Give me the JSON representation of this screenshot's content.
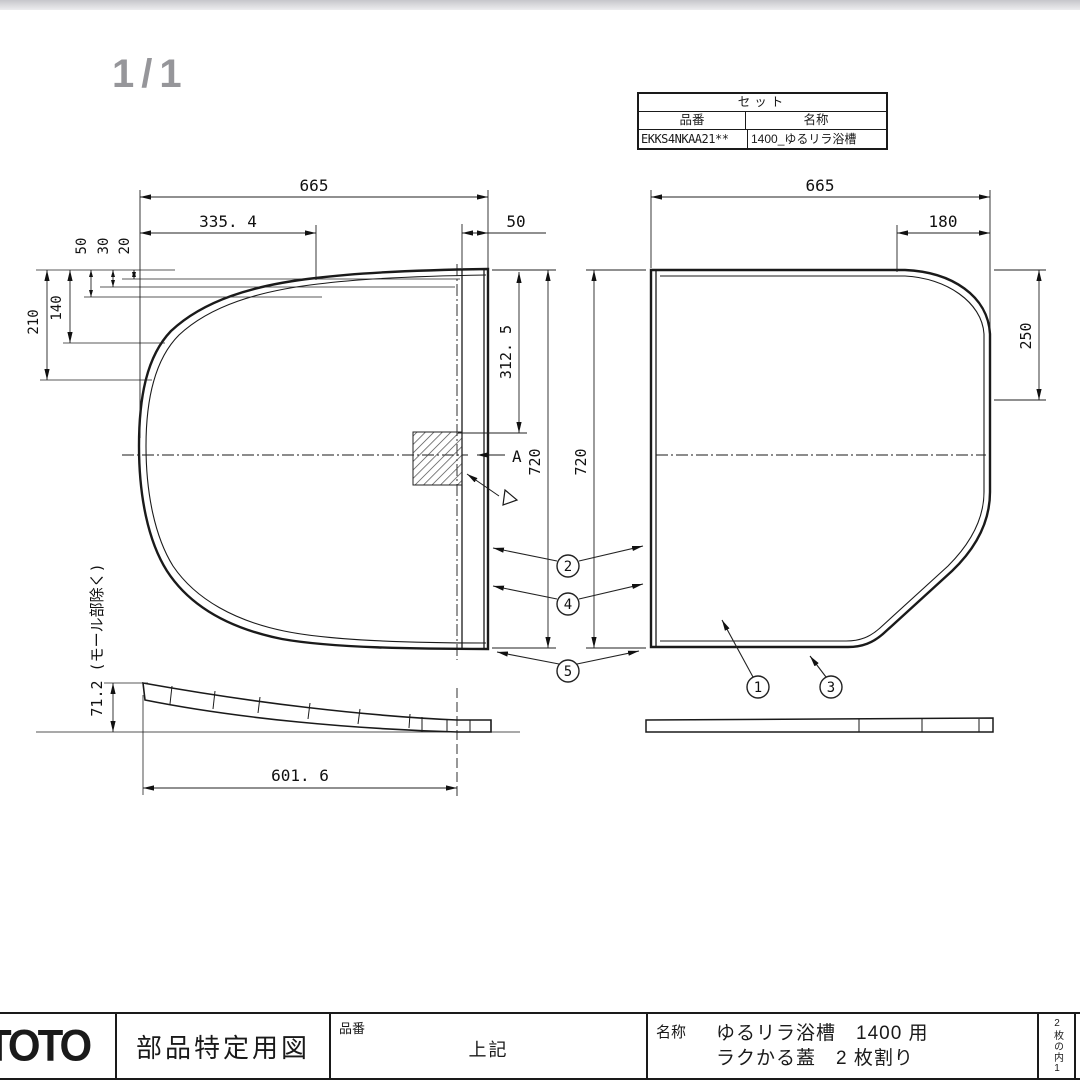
{
  "page": {
    "indicator": "1/1"
  },
  "set_table": {
    "title": "セット",
    "col_part": "品番",
    "col_name": "名称",
    "part_no": "EKKS4NKAA21**",
    "name": "1400_ゆるリラ浴槽"
  },
  "dims": {
    "left_width": "665",
    "left_partial": "335. 4",
    "offset_50": "50",
    "offset_30": "30",
    "offset_20": "20",
    "left_210": "210",
    "left_140": "140",
    "section_offset": "312. 5",
    "strip_width": "50",
    "left_height": "720",
    "right_height": "720",
    "right_width": "665",
    "right_partial": "180",
    "right_side": "250",
    "profile_length": "601. 6",
    "profile_height": "71.2 (モール部除く)",
    "section_label": "A"
  },
  "callouts": {
    "c1": "1",
    "c2": "2",
    "c3": "3",
    "c4": "4",
    "c5": "5"
  },
  "title_block": {
    "logo": "TOTO",
    "doc_type": "部品特定用図",
    "part_label": "品番",
    "part_value": "上記",
    "name_label": "名称",
    "name_line1": "ゆるリラ浴槽　1400 用",
    "name_line2": "ラクかる蓋　2 枚割り",
    "sheet_note": "2枚の内1"
  }
}
